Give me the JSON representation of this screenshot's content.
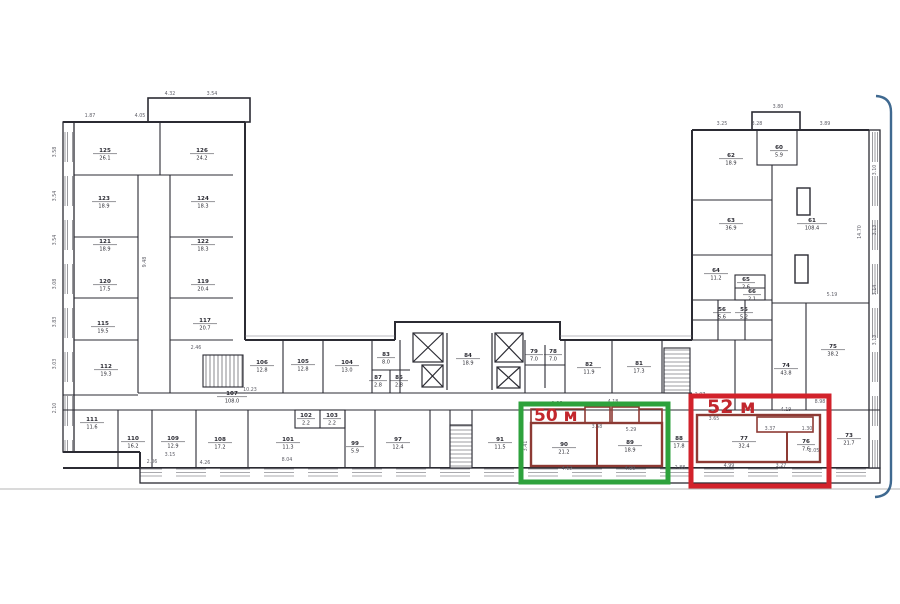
{
  "document": {
    "type": "floor-plan-scan",
    "background": "#ffffff",
    "wall_color": "#2b2b33",
    "apartment_wall_color": "#8d3a34",
    "dim_color": "#5f5f68",
    "ground_line_color": "#b5b5b5",
    "page_edge_color": "#1d4f7c"
  },
  "highlights": [
    {
      "id": "green-50m",
      "label": "50 м",
      "box_color": "#2ea23c",
      "label_color": "#c2272d",
      "x": 521,
      "y": 404,
      "w": 147,
      "h": 78,
      "lx": 534,
      "ly": 421,
      "fs": 17
    },
    {
      "id": "red-52m",
      "label": "52 м",
      "box_color": "#d2222b",
      "label_color": "#c2272d",
      "x": 691,
      "y": 396,
      "w": 138,
      "h": 90,
      "lx": 707,
      "ly": 413,
      "fs": 19
    }
  ],
  "plan": {
    "rooms": [
      {
        "n": "125",
        "a": "26.1",
        "x": 105,
        "y": 152
      },
      {
        "n": "126",
        "a": "24.2",
        "x": 202,
        "y": 152
      },
      {
        "n": "123",
        "a": "18.9",
        "x": 104,
        "y": 200
      },
      {
        "n": "124",
        "a": "18.3",
        "x": 203,
        "y": 200
      },
      {
        "n": "121",
        "a": "18.9",
        "x": 105,
        "y": 243
      },
      {
        "n": "122",
        "a": "18.3",
        "x": 203,
        "y": 243
      },
      {
        "n": "120",
        "a": "17.5",
        "x": 105,
        "y": 283
      },
      {
        "n": "119",
        "a": "20.4",
        "x": 203,
        "y": 283
      },
      {
        "n": "115",
        "a": "19.5",
        "x": 103,
        "y": 325
      },
      {
        "n": "117",
        "a": "20.7",
        "x": 205,
        "y": 322
      },
      {
        "n": "112",
        "a": "19.3",
        "x": 106,
        "y": 368
      },
      {
        "n": "111",
        "a": "11.6",
        "x": 92,
        "y": 421
      },
      {
        "n": "110",
        "a": "16.2",
        "x": 133,
        "y": 440
      },
      {
        "n": "109",
        "a": "12.9",
        "x": 173,
        "y": 440
      },
      {
        "n": "108",
        "a": "17.2",
        "x": 220,
        "y": 441
      },
      {
        "n": "101",
        "a": "11.3",
        "x": 288,
        "y": 441
      },
      {
        "n": "102",
        "a": "2.2",
        "x": 306,
        "y": 417
      },
      {
        "n": "103",
        "a": "2.2",
        "x": 332,
        "y": 417
      },
      {
        "n": "99",
        "a": "5.9",
        "x": 355,
        "y": 445
      },
      {
        "n": "97",
        "a": "12.4",
        "x": 398,
        "y": 441
      },
      {
        "n": "107",
        "a": "108.0",
        "x": 232,
        "y": 395
      },
      {
        "n": "106",
        "a": "12.8",
        "x": 262,
        "y": 364
      },
      {
        "n": "105",
        "a": "12.8",
        "x": 303,
        "y": 363
      },
      {
        "n": "104",
        "a": "13.0",
        "x": 347,
        "y": 364
      },
      {
        "n": "83",
        "a": "8.0",
        "x": 386,
        "y": 356
      },
      {
        "n": "87",
        "a": "2.8",
        "x": 378,
        "y": 379
      },
      {
        "n": "85",
        "a": "2.8",
        "x": 399,
        "y": 379
      },
      {
        "n": "84",
        "a": "18.9",
        "x": 468,
        "y": 357
      },
      {
        "n": "79",
        "a": "7.0",
        "x": 534,
        "y": 353
      },
      {
        "n": "78",
        "a": "7.0",
        "x": 553,
        "y": 353
      },
      {
        "n": "82",
        "a": "11.9",
        "x": 589,
        "y": 366
      },
      {
        "n": "81",
        "a": "17.3",
        "x": 639,
        "y": 365
      },
      {
        "n": "91",
        "a": "11.5",
        "x": 500,
        "y": 441
      },
      {
        "n": "90",
        "a": "21.2",
        "x": 564,
        "y": 446
      },
      {
        "n": "89",
        "a": "18.9",
        "x": 630,
        "y": 444
      },
      {
        "n": "88",
        "a": "17.8",
        "x": 679,
        "y": 440
      },
      {
        "n": "77",
        "a": "32.4",
        "x": 744,
        "y": 440
      },
      {
        "n": "76",
        "a": "7.6",
        "x": 806,
        "y": 443
      },
      {
        "n": "73",
        "a": "21.7",
        "x": 849,
        "y": 437
      },
      {
        "n": "62",
        "a": "18.9",
        "x": 731,
        "y": 157
      },
      {
        "n": "60",
        "a": "5.9",
        "x": 779,
        "y": 149
      },
      {
        "n": "61",
        "a": "108.4",
        "x": 812,
        "y": 222
      },
      {
        "n": "63",
        "a": "36.9",
        "x": 731,
        "y": 222
      },
      {
        "n": "64",
        "a": "11.2",
        "x": 716,
        "y": 272
      },
      {
        "n": "65",
        "a": "2.6",
        "x": 746,
        "y": 281
      },
      {
        "n": "66",
        "a": "2.1",
        "x": 752,
        "y": 293
      },
      {
        "n": "56",
        "a": "5.6",
        "x": 722,
        "y": 311
      },
      {
        "n": "55",
        "a": "5.2",
        "x": 744,
        "y": 311
      },
      {
        "n": "74",
        "a": "43.8",
        "x": 786,
        "y": 367
      },
      {
        "n": "75",
        "a": "38.2",
        "x": 833,
        "y": 348
      }
    ],
    "dims": [
      {
        "t": "3.58",
        "x": 56,
        "y": 152,
        "r": 1
      },
      {
        "t": "3.54",
        "x": 56,
        "y": 196,
        "r": 1
      },
      {
        "t": "3.54",
        "x": 56,
        "y": 240,
        "r": 1
      },
      {
        "t": "3.08",
        "x": 56,
        "y": 284,
        "r": 1
      },
      {
        "t": "3.83",
        "x": 56,
        "y": 322,
        "r": 1
      },
      {
        "t": "3.03",
        "x": 56,
        "y": 364,
        "r": 1
      },
      {
        "t": "2.10",
        "x": 56,
        "y": 408,
        "r": 1
      },
      {
        "t": "4.32",
        "x": 170,
        "y": 95,
        "r": 0
      },
      {
        "t": "3.54",
        "x": 212,
        "y": 95,
        "r": 0
      },
      {
        "t": "1.87",
        "x": 90,
        "y": 117,
        "r": 0
      },
      {
        "t": "4.05",
        "x": 140,
        "y": 117,
        "r": 0
      },
      {
        "t": "9.48",
        "x": 146,
        "y": 262,
        "r": 1
      },
      {
        "t": "3.25",
        "x": 722,
        "y": 125,
        "r": 0
      },
      {
        "t": "3.28",
        "x": 757,
        "y": 125,
        "r": 0
      },
      {
        "t": "3.89",
        "x": 825,
        "y": 125,
        "r": 0
      },
      {
        "t": "3.80",
        "x": 778,
        "y": 108,
        "r": 0
      },
      {
        "t": "3.10",
        "x": 876,
        "y": 170,
        "r": 1
      },
      {
        "t": "3.13",
        "x": 876,
        "y": 230,
        "r": 1
      },
      {
        "t": "3.14",
        "x": 876,
        "y": 290,
        "r": 1
      },
      {
        "t": "3.13",
        "x": 876,
        "y": 340,
        "r": 1
      },
      {
        "t": "14.70",
        "x": 861,
        "y": 232,
        "r": 1
      },
      {
        "t": "5.19",
        "x": 832,
        "y": 296,
        "r": 0
      },
      {
        "t": "10.23",
        "x": 250,
        "y": 391,
        "r": 0
      },
      {
        "t": "2.46",
        "x": 196,
        "y": 349,
        "r": 0
      },
      {
        "t": "1.86",
        "x": 557,
        "y": 405,
        "r": 0
      },
      {
        "t": "4.18",
        "x": 613,
        "y": 403,
        "r": 0
      },
      {
        "t": "3.75",
        "x": 656,
        "y": 406,
        "r": 0
      },
      {
        "t": "3.58",
        "x": 597,
        "y": 428,
        "r": 0
      },
      {
        "t": "5.29",
        "x": 631,
        "y": 431,
        "r": 0
      },
      {
        "t": "3.41",
        "x": 527,
        "y": 446,
        "r": 1
      },
      {
        "t": "4.12",
        "x": 567,
        "y": 470,
        "r": 0
      },
      {
        "t": "4.90",
        "x": 630,
        "y": 470,
        "r": 0
      },
      {
        "t": "2.88",
        "x": 680,
        "y": 469,
        "r": 0
      },
      {
        "t": "3.65",
        "x": 714,
        "y": 420,
        "r": 0
      },
      {
        "t": "4.19",
        "x": 786,
        "y": 411,
        "r": 0
      },
      {
        "t": "8.98",
        "x": 820,
        "y": 403,
        "r": 0
      },
      {
        "t": "3.37",
        "x": 770,
        "y": 430,
        "r": 0
      },
      {
        "t": "1.30",
        "x": 807,
        "y": 430,
        "r": 0
      },
      {
        "t": "2.05",
        "x": 814,
        "y": 452,
        "r": 0
      },
      {
        "t": "4.99",
        "x": 729,
        "y": 467,
        "r": 0
      },
      {
        "t": "3.27",
        "x": 781,
        "y": 467,
        "r": 0
      },
      {
        "t": "2.07",
        "x": 700,
        "y": 396,
        "r": 0
      },
      {
        "t": "4.26",
        "x": 205,
        "y": 464,
        "r": 0
      },
      {
        "t": "3.15",
        "x": 170,
        "y": 456,
        "r": 0
      },
      {
        "t": "2.06",
        "x": 152,
        "y": 463,
        "r": 0
      },
      {
        "t": "8.04",
        "x": 287,
        "y": 461,
        "r": 0
      }
    ]
  }
}
